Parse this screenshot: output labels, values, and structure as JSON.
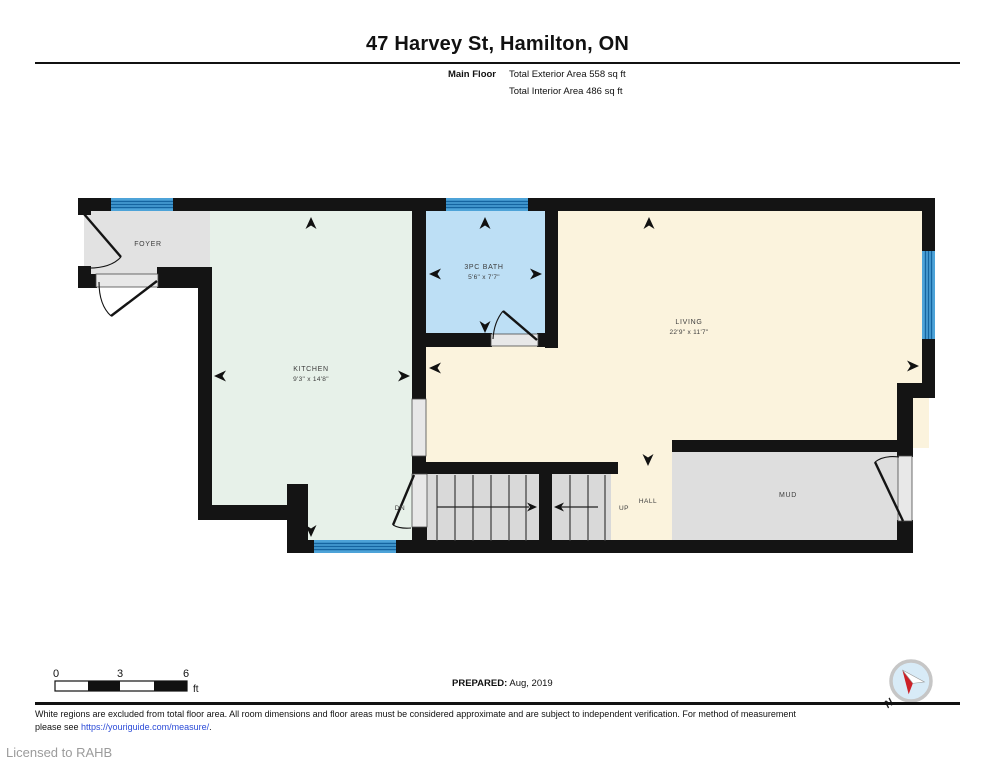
{
  "header": {
    "title": "47 Harvey St, Hamilton, ON",
    "floor_label": "Main Floor",
    "exterior_area": "Total Exterior Area 558 sq ft",
    "interior_area": "Total Interior Area 486 sq ft"
  },
  "rooms": {
    "foyer": {
      "name": "FOYER"
    },
    "kitchen": {
      "name": "KITCHEN",
      "dims": "9'3\" x 14'8\""
    },
    "bath": {
      "name": "3PC BATH",
      "dims": "5'6\" x 7'7\""
    },
    "living": {
      "name": "LIVING",
      "dims": "22'9\" x 11'7\""
    },
    "hall": {
      "name": "HALL"
    },
    "mud": {
      "name": "MUD"
    },
    "stairs": {
      "up_label": "UP",
      "down_label": "DN"
    }
  },
  "scale_bar": {
    "tick0": "0",
    "tick3": "3",
    "tick6": "6",
    "unit": "ft"
  },
  "prepared": {
    "label": "PREPARED:",
    "date": "Aug, 2019"
  },
  "compass": {
    "north_label": "N"
  },
  "footer": {
    "disclaimer_line1": "White regions are excluded from total floor area. All room dimensions and floor areas must be considered approximate and are subject to independent verification. For method of measurement",
    "disclaimer_line2_prefix": "please see ",
    "measure_link": "https://youriguide.com/measure/",
    "disclaimer_line2_suffix": ".",
    "license": "Licensed to RAHB"
  },
  "palette": {
    "kitchen_fill": "#e7f1e9",
    "bath_fill": "#bddff5",
    "living_fill": "#fbf3dd",
    "foyer_fill": "#e2e2e2",
    "mud_fill": "#dedede",
    "stairs_fill": "#d9d9d9",
    "window_fill": "#4da3d8",
    "window_stripe": "#1565a0",
    "wall": "#141414",
    "compass_red": "#cc2027",
    "link_blue": "#2b4bd7"
  }
}
